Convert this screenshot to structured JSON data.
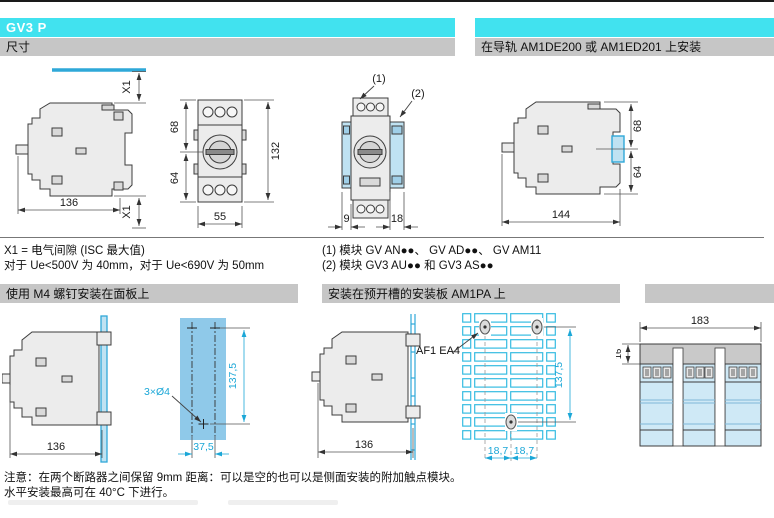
{
  "page": {
    "title": "GV3 P"
  },
  "banners": {
    "section1_left": "尺寸",
    "section1_right": "在导轨 AM1DE200 或 AM1ED201 上安装",
    "section2_left": "使用 M4 螺钉安装在面板上",
    "section2_mid": "安装在预开槽的安装板 AM1PA 上"
  },
  "notes": {
    "x1_def": "X1 = 电气间隙 (ISC 最大值)",
    "x1_values": "对于 Ue<500V 为 40mm，对于 Ue<690V 为 50mm",
    "module_1": "(1) 模块 GV AN●●、 GV AD●●、 GV AM11",
    "module_2": "(2) 模块 GV3 AU●● 和 GV3 AS●●",
    "caution_1": "注意：在两个断路器之间保留 9mm 距离：可以是空的也可以是侧面安装的附加触点模块。",
    "caution_2": "水平安装最高可在 40°C 下进行。"
  },
  "drawings": {
    "side_view": {
      "width": "136",
      "clearance_top": "X1",
      "clearance_bottom": "X1"
    },
    "front_view": {
      "upper": "68",
      "lower": "64",
      "height": "132",
      "width": "55"
    },
    "with_modules": {
      "callout1": "(1)",
      "callout2": "(2)",
      "left": "9",
      "right": "18"
    },
    "rail_view": {
      "upper": "68",
      "lower": "64",
      "width": "144"
    },
    "panel_view": {
      "width": "136"
    },
    "drill_template": {
      "holes": "3×Ø4",
      "v_pitch": "137,5",
      "h_pitch": "37,5"
    },
    "slotted_view": {
      "width": "136",
      "clip_label": "AF1 EA4"
    },
    "plate_view": {
      "v_pitch": "137,5",
      "pitch_left": "18,7",
      "pitch_right": "18,7"
    },
    "group_view": {
      "width": "183",
      "gap": "16"
    }
  },
  "colors": {
    "accent_cyan": "#41E2EF",
    "banner_gray": "#C6C6C6",
    "drawing_blue": "#2FA8D8",
    "module_fill": "#BFE2F2",
    "template_fill": "#8FC9E9",
    "body_fill": "#ECECEC",
    "dim_blue_text": "#1BA7D7"
  }
}
